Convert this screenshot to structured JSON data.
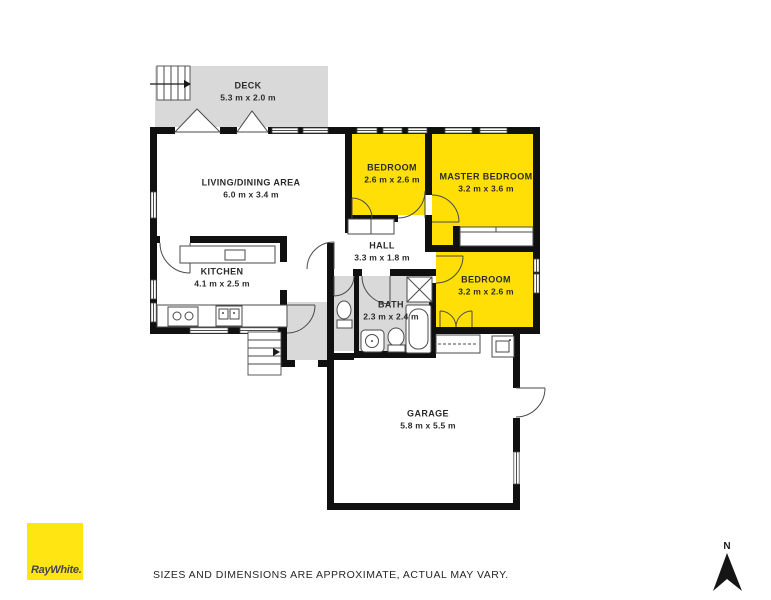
{
  "plan": {
    "rooms": [
      {
        "id": "deck",
        "name": "DECK",
        "dims": "5.3 m x 2.0 m",
        "highlight": false
      },
      {
        "id": "living",
        "name": "LIVING/DINING AREA",
        "dims": "6.0 m x 3.4 m",
        "highlight": false
      },
      {
        "id": "bedroom-1",
        "name": "BEDROOM",
        "dims": "2.6 m x 2.6 m",
        "highlight": true
      },
      {
        "id": "master-bedroom",
        "name": "MASTER BEDROOM",
        "dims": "3.2 m x 3.6 m",
        "highlight": true
      },
      {
        "id": "hall",
        "name": "HALL",
        "dims": "3.3 m x 1.8 m",
        "highlight": false
      },
      {
        "id": "kitchen",
        "name": "KITCHEN",
        "dims": "4.1 m x 2.5 m",
        "highlight": false
      },
      {
        "id": "bath",
        "name": "BATH",
        "dims": "2.3 m x 2.4 m",
        "highlight": false
      },
      {
        "id": "bedroom-2",
        "name": "BEDROOM",
        "dims": "3.2 m x 2.6 m",
        "highlight": true
      },
      {
        "id": "garage",
        "name": "GARAGE",
        "dims": "5.8 m x 5.5 m",
        "highlight": false
      }
    ],
    "colors": {
      "highlight_yellow": "#ffdf05",
      "area_gray": "#d9d9d9",
      "wall_black": "#101010"
    }
  },
  "footer": {
    "disclaimer": "SIZES AND DIMENSIONS ARE APPROXIMATE, ACTUAL MAY VARY.",
    "logo_text": "RayWhite.",
    "logo_color": "#ffe512"
  },
  "compass": {
    "north_label": "N"
  }
}
